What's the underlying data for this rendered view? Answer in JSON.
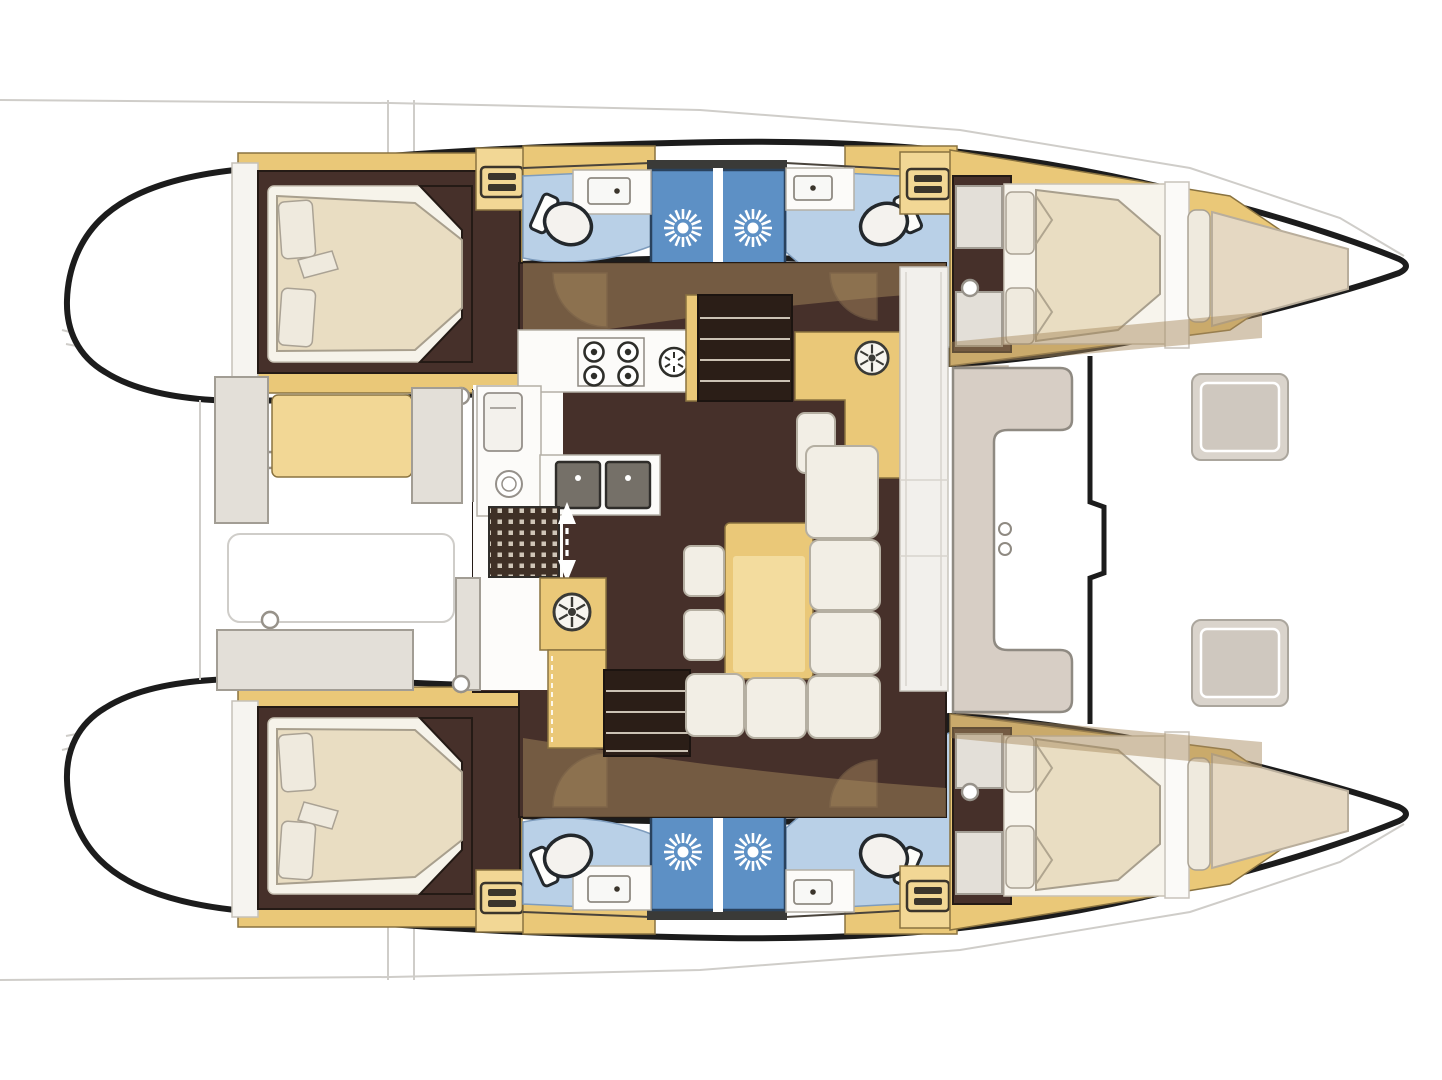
{
  "page": {
    "background": "#ffffff",
    "width": 1442,
    "height": 1080
  },
  "vessel": {
    "type": "catamaran",
    "view": "top-down interior deck / floor plan",
    "orientation": "bows pointing right, sterns with swim platforms on the left",
    "symmetry": "port and starboard hulls mirrored about horizontal centerline"
  },
  "colors": {
    "paper": "#ffffff",
    "outline": "#1c1c1c",
    "wood": "#eac878",
    "wood-light": "#f2d795",
    "wood-edge": "#8a7340",
    "floor-brown": "#46302a",
    "floor-brown-edge": "#241a15",
    "deck-tan": "#a8895f",
    "deck-tan-edge": "#8a7152",
    "bath-blue": "#b9d0e7",
    "bath-blue-edge": "#7e9cbd",
    "shower-blue": "#5d90c5",
    "shower-edge": "#29425e",
    "mattress": "#e9ddc2",
    "mattress-edge": "#a89f8d",
    "pillow": "#efeade",
    "pillow-edge": "#aaa294",
    "cushion": "#f2eee5",
    "cushion-edge": "#b5afa2",
    "bench": "#e3dfd8",
    "bench-edge": "#a29d94",
    "seat-taupe": "#d7cec5",
    "seat-taupe-edge": "#8f8a82",
    "faint": "#cfcdc9",
    "stairs": "#2b1e17",
    "stair-tread": "#cbc2b4",
    "icon-dark": "#3b352c"
  },
  "plan": {
    "hulls": [
      {
        "name": "top hull",
        "rooms": [
          "aft double cabin with island bed and two pillows",
          "bathroom with toilet and washbasin",
          "two separate shower stalls",
          "second bathroom with toilet and washbasin",
          "forward double cabin with bed and two pillows",
          "forepeak crew berth in bow"
        ]
      },
      {
        "name": "bottom hull",
        "rooms": [
          "aft double cabin with island bed and two pillows",
          "bathroom with toilet and washbasin",
          "two separate shower stalls",
          "second bathroom with toilet and washbasin",
          "forward double cabin with bed and two pillows",
          "forepeak crew berth in bow"
        ]
      }
    ],
    "bridgedeck": {
      "aft_cockpit": [
        "side bench",
        "cockpit table",
        "aft bench",
        "step seat",
        "mooring cleats"
      ],
      "salon": [
        "galley counter with 4-burner stove and single burner",
        "refrigerator cabinet",
        "double square sink unit",
        "floor grate",
        "companionway up-down arrows",
        "mast foot post",
        "chart table with instrument dial",
        "navigator seat",
        "L-shaped sofa",
        "salon table",
        "two stools",
        "stairs down to each hull"
      ],
      "forward_cockpit": [
        "C-shaped forward seat",
        "two cup holders",
        "forward crossbeam"
      ],
      "foredeck": [
        "two deck hatches",
        "trampoline area (white)"
      ]
    },
    "fixture_counts": {
      "double_beds": 4,
      "bow_berths": 2,
      "toilets": 4,
      "shower_stalls": 4,
      "bathroom_sinks": 4,
      "stove_burners": 5,
      "galley_sinks": 2
    }
  },
  "icons": [
    "shower-spray-icon",
    "toilet-icon",
    "washbasin-icon",
    "burner-icon",
    "helm-dial-icon",
    "mast-foot-icon",
    "companionway-arrows-icon",
    "dresser-icon",
    "cleat-icon",
    "floor-grate-icon"
  ]
}
